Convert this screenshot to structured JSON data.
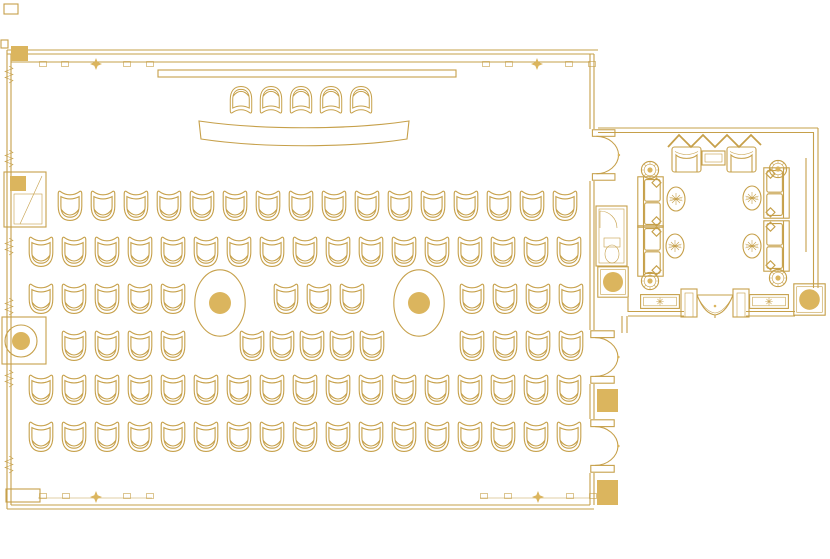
{
  "colors": {
    "line": "#C6A04A",
    "fill": "#DBB55E",
    "background": "#FFFFFF"
  },
  "counts": {
    "audience_chairs": 92,
    "head_chairs": 5,
    "columns": 2,
    "sofas": 4,
    "armchairs": 2,
    "planters": 4,
    "rugs": 4
  },
  "seating": {
    "head_row": {
      "count": 5,
      "x_start": 228,
      "pitch": 30,
      "y": 85,
      "facing": "down"
    },
    "rows": [
      {
        "name": "row-1",
        "y": 189,
        "groups": [
          {
            "x_start": 56,
            "count": 16,
            "pitch": 33
          }
        ]
      },
      {
        "name": "row-2",
        "y": 235,
        "groups": [
          {
            "x_start": 27,
            "count": 17,
            "pitch": 33
          }
        ]
      },
      {
        "name": "row-3",
        "y": 282,
        "groups": [
          {
            "x_start": 27,
            "count": 5,
            "pitch": 33
          },
          {
            "x_start": 272,
            "count": 3,
            "pitch": 33
          },
          {
            "x_start": 458,
            "count": 4,
            "pitch": 33
          }
        ]
      },
      {
        "name": "row-4",
        "y": 329,
        "groups": [
          {
            "x_start": 60,
            "count": 4,
            "pitch": 33
          },
          {
            "x_start": 238,
            "count": 5,
            "pitch": 30
          },
          {
            "x_start": 458,
            "count": 4,
            "pitch": 33
          }
        ]
      },
      {
        "name": "row-5",
        "y": 373,
        "groups": [
          {
            "x_start": 27,
            "count": 17,
            "pitch": 33
          }
        ]
      },
      {
        "name": "row-6",
        "y": 420,
        "groups": [
          {
            "x_start": 27,
            "count": 17,
            "pitch": 33
          }
        ]
      }
    ]
  },
  "columns": [
    {
      "cx": 220,
      "cy": 303
    },
    {
      "cx": 419,
      "cy": 303
    }
  ],
  "furniture": {
    "sofas": [
      {
        "x": 637,
        "y": 176,
        "facing": "right"
      },
      {
        "x": 637,
        "y": 225,
        "facing": "right"
      },
      {
        "x": 763,
        "y": 167,
        "facing": "left"
      },
      {
        "x": 763,
        "y": 220,
        "facing": "left"
      }
    ],
    "armchairs": [
      {
        "x": 671,
        "y": 146
      },
      {
        "x": 726,
        "y": 146
      }
    ],
    "coffee_table": {
      "x": 702,
      "y": 151,
      "w": 23,
      "h": 14
    },
    "planters": [
      {
        "cx": 650,
        "cy": 170
      },
      {
        "cx": 778,
        "cy": 169
      },
      {
        "cx": 650,
        "cy": 281
      },
      {
        "cx": 778,
        "cy": 278
      }
    ],
    "rugs": [
      {
        "cx": 676,
        "cy": 199
      },
      {
        "cx": 752,
        "cy": 198
      },
      {
        "cx": 675,
        "cy": 246
      },
      {
        "cx": 752,
        "cy": 246
      }
    ],
    "wall_panels": [
      {
        "x": 640,
        "y": 292
      },
      {
        "x": 749,
        "y": 292
      }
    ],
    "piers_circle": [
      {
        "x": 597,
        "y": 266,
        "s": 32
      },
      {
        "x": 793,
        "y": 283,
        "s": 33
      }
    ],
    "piers_solid": [
      {
        "x": 597,
        "y": 389,
        "w": 21,
        "h": 23
      },
      {
        "x": 597,
        "y": 480,
        "w": 21,
        "h": 25
      },
      {
        "x": 11,
        "y": 46,
        "w": 17,
        "h": 15
      }
    ],
    "doors": [
      {
        "x": 591,
        "y": 129,
        "h": 52
      },
      {
        "x": 590,
        "y": 330,
        "h": 54
      },
      {
        "x": 590,
        "y": 419,
        "h": 54
      }
    ]
  }
}
